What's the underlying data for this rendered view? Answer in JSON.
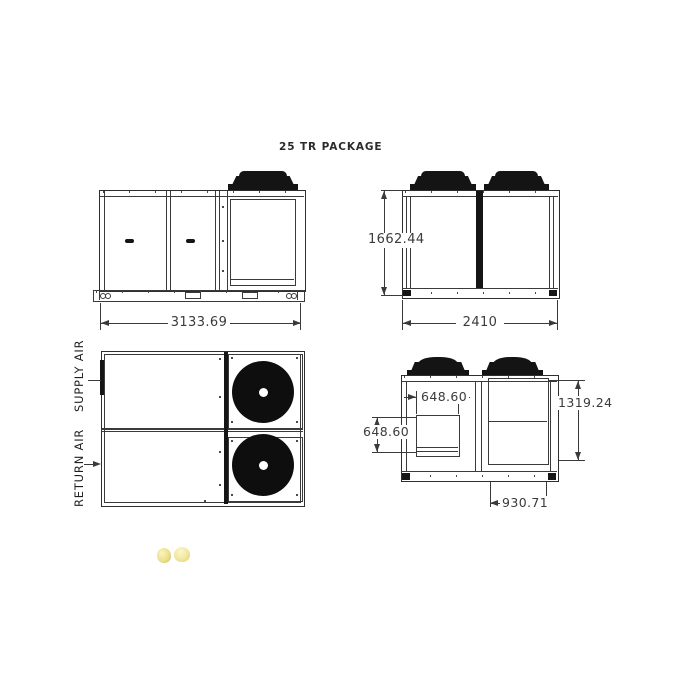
{
  "title": "25 TR PACKAGE",
  "colors": {
    "line": "#3a3a3a",
    "text": "#3b3b3b",
    "fill_dark": "#151515",
    "watermark_yellow": "#ecdf8e"
  },
  "views": {
    "side_elevation": {
      "overall_length": "3133.69"
    },
    "front_elevation": {
      "overall_height": "1662.44",
      "overall_width": "2410"
    },
    "plan": {
      "supply_air_label": "SUPPLY AIR",
      "return_air_label": "RETURN AIR"
    },
    "end_elevation": {
      "opening_width": "648.60",
      "opening_height": "648.60",
      "condenser_height": "1319.24",
      "condenser_width": "930.71"
    }
  }
}
